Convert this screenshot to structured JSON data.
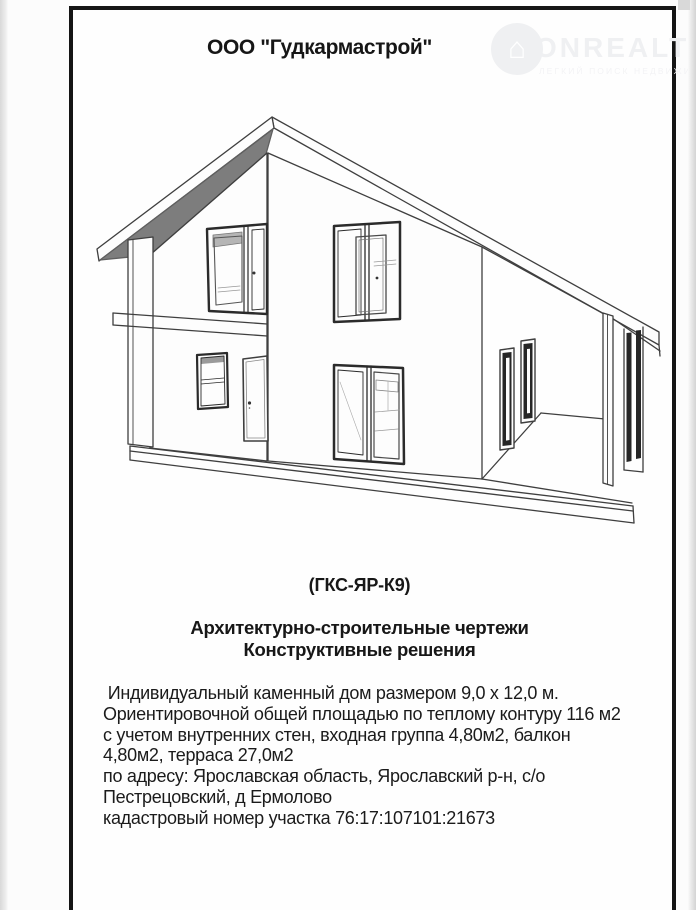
{
  "doc": {
    "company_title": "ООО \"Гудкармастрой\"",
    "project_code": "(ГКС-ЯР-К9)",
    "heading_line1": "Архитектурно-строительные чертежи",
    "heading_line2": "Конструктивные решения",
    "description": [
      " Индивидуальный каменный дом размером 9,0 х 12,0 м.",
      "Ориентировочной общей площадью по теплому контуру 116 м2",
      "с учетом внутренних стен, входная группа 4,80м2, балкон",
      "4,80м2, терраса 27,0м2",
      "по адресу: Ярославская область, Ярославский р-н, с/о",
      "Пестрецовский, д Ермолово",
      "кадастровый номер участка 76:17:107101:21673"
    ]
  },
  "watermark": {
    "brand": "ONREALT",
    "tagline": "ЛЕГКИЙ ПОИСК НЕДВИЖИМОСТИ",
    "icon_glyph": "⌂"
  },
  "drawing": {
    "caption": "3D line drawing of two-story gable house with terrace",
    "colors": {
      "line": "#3f3f3f",
      "soffit_gray": "#7d7d7d",
      "window_frame_dark": "#262626",
      "paper": "#fefefe",
      "page_frame": "#141414",
      "watermark_gray": "#eff0f2"
    }
  }
}
